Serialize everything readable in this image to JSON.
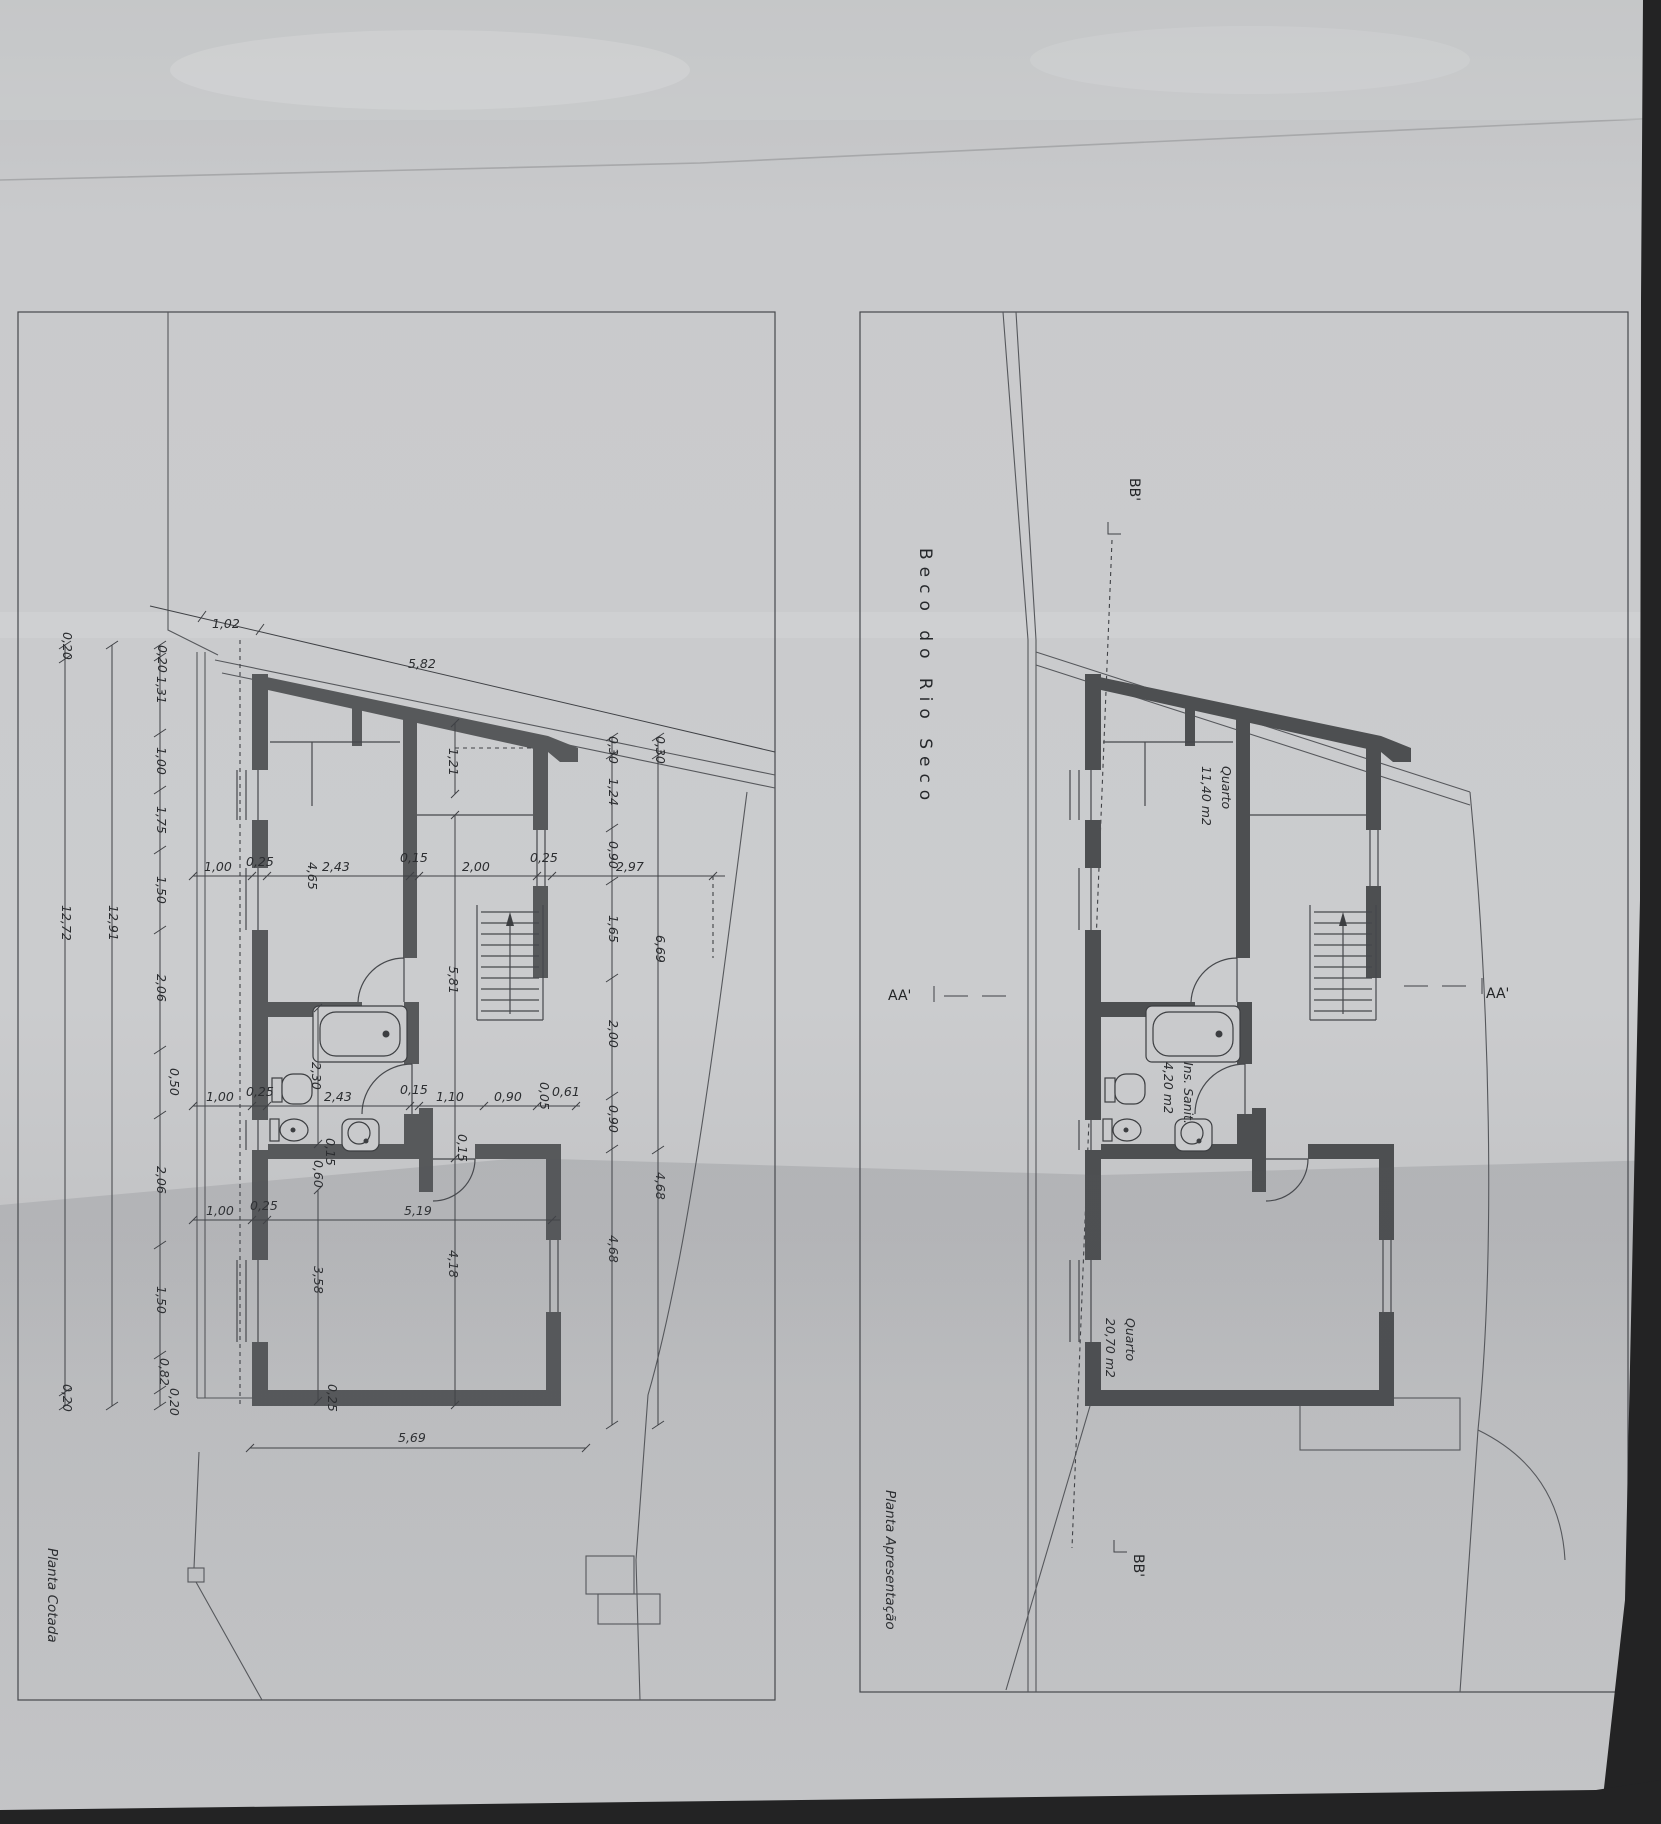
{
  "sheet": {
    "street_title": "Beco do Rio Seco",
    "left_plan_label": "Planta Cotada",
    "right_plan_label": "Planta Apresentação"
  },
  "colors": {
    "paper": "#c7c8ca",
    "line": "#46484c",
    "wall_left_plan": "#57595b",
    "wall_right_plan": "#4d4f51",
    "shadow_edge": "#232324"
  },
  "rooms": {
    "quarto1": {
      "name": "Quarto",
      "area": "11,40 m2"
    },
    "sanit": {
      "name": "Ins. Sanit.",
      "area": "4,20 m2"
    },
    "quarto2": {
      "name": "Quarto",
      "area": "20,70 m2"
    }
  },
  "sections": {
    "bb": "BB'",
    "aa": "AA'"
  },
  "dims": {
    "left_chain": [
      "0,20",
      "1,31",
      "1,00",
      "1,75",
      "1,50",
      "2,06",
      "0,50",
      "2,06",
      "1,50",
      "0,82",
      "0,20"
    ],
    "left_total_inner": "12,91",
    "left_total_outer": "12,72",
    "outer_top": "0,20",
    "outer_bottom": "0,20",
    "top_small": "1,02",
    "top_long": "5,82",
    "right_inner": [
      "0,30",
      "1,24",
      "0,90",
      "1,65",
      "2,00",
      "0,90",
      "4,68"
    ],
    "right_outer": [
      "0,30",
      "6,69",
      "4,68"
    ],
    "row1": [
      "1,00",
      "0,25",
      "4,65",
      "2,43",
      "0,15",
      "2,00",
      "0,25",
      "2,97"
    ],
    "row2": [
      "1,00",
      "0,25",
      "2,43",
      "0,15",
      "1,10",
      "0,90",
      "0,05",
      "0,61"
    ],
    "row3": [
      "1,00",
      "0,25",
      "5,19"
    ],
    "vertical": [
      "1,21",
      "5,81",
      "2,30",
      "3,58",
      "4,18"
    ],
    "wall_small": [
      "0,15",
      "0,60",
      "0,15",
      "0,25"
    ],
    "bottom_total": "5,69"
  }
}
